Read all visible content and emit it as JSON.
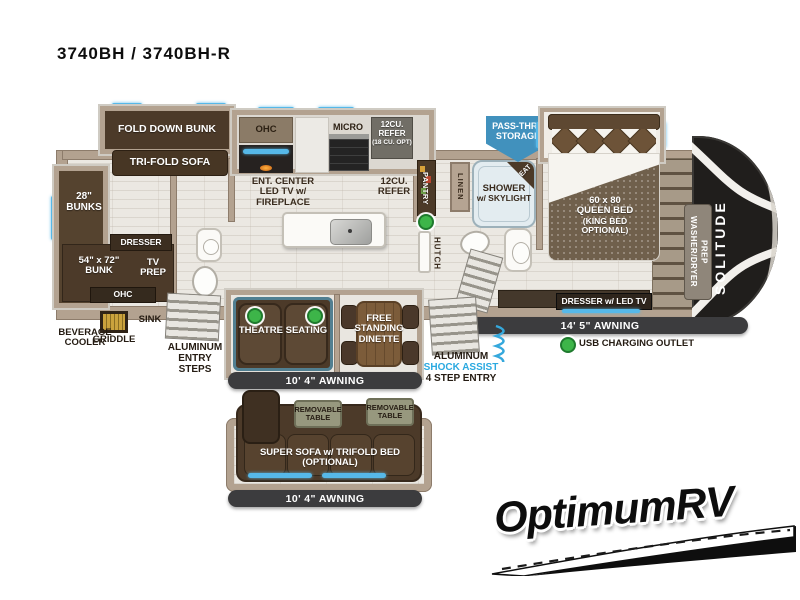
{
  "title": "3740BH / 3740BH-R",
  "branding": {
    "logo": "OptimumRV"
  },
  "colors": {
    "accent_blue": "#56B8E8",
    "badge_blue": "#4191BD",
    "usb_green": "#3DB549",
    "awning_dark": "#3C3C3E",
    "wall_tan": "#B3A290",
    "furniture_brown": "#4C3A29",
    "shock_assist_blue": "#2AA9E0"
  },
  "plan": {
    "bunk_room": {
      "fold_down_bunk": "FOLD DOWN BUNK",
      "tri_fold_sofa": "TRI-FOLD SOFA",
      "bunks_28": "28\" BUNKS",
      "dresser": "DRESSER",
      "bunk_54x72": "54\" x 72\" BUNK",
      "tv_prep": "TV PREP",
      "ohc": "OHC"
    },
    "exterior_left": {
      "beverage_cooler": "BEVERAGE COOLER",
      "griddle": "GRIDDLE",
      "sink": "SINK",
      "entry_steps": "ALUMINUM ENTRY STEPS"
    },
    "kitchen": {
      "ohc": "OHC",
      "micro": "MICRO",
      "refer": "12CU. REFER",
      "refer_opt": "(18 CU. OPT)",
      "refer_floor": "12CU. REFER",
      "ent_center": "ENT. CENTER",
      "ent_center2": "LED TV w/ FIREPLACE",
      "pantry": "PANTRY",
      "hutch": "HUTCH"
    },
    "bath": {
      "linen": "LINEN",
      "shower": "SHOWER",
      "shower2": "w/ SKYLIGHT",
      "seat": "SEAT"
    },
    "storage": {
      "line1": "PASS-THRU",
      "line2": "STORAGE"
    },
    "bedroom": {
      "bed1": "60 x 80",
      "bed2": "QUEEN BED",
      "bed3": "(KING BED",
      "bed4": "OPTIONAL)",
      "dresser_tv": "DRESSER w/ LED TV",
      "washer_dryer": "WASHER/DRYER PREP",
      "brand": "SOLITUDE"
    },
    "living": {
      "theatre": "THEATRE SEATING",
      "dinette": "FREE STANDING DINETTE"
    },
    "awnings": {
      "main": "10' 4\" AWNING",
      "bedroom": "14' 5\" AWNING",
      "sofa": "10' 4\" AWNING"
    },
    "entry": {
      "l1": "ALUMINUM",
      "l2": "SHOCK ASSIST",
      "l3": "4 STEP ENTRY"
    },
    "legend": {
      "usb": "USB CHARGING OUTLET"
    },
    "sofa_option": {
      "label": "SUPER SOFA w/ TRIFOLD BED",
      "label2": "(OPTIONAL)",
      "table": "REMOVABLE TABLE"
    }
  }
}
